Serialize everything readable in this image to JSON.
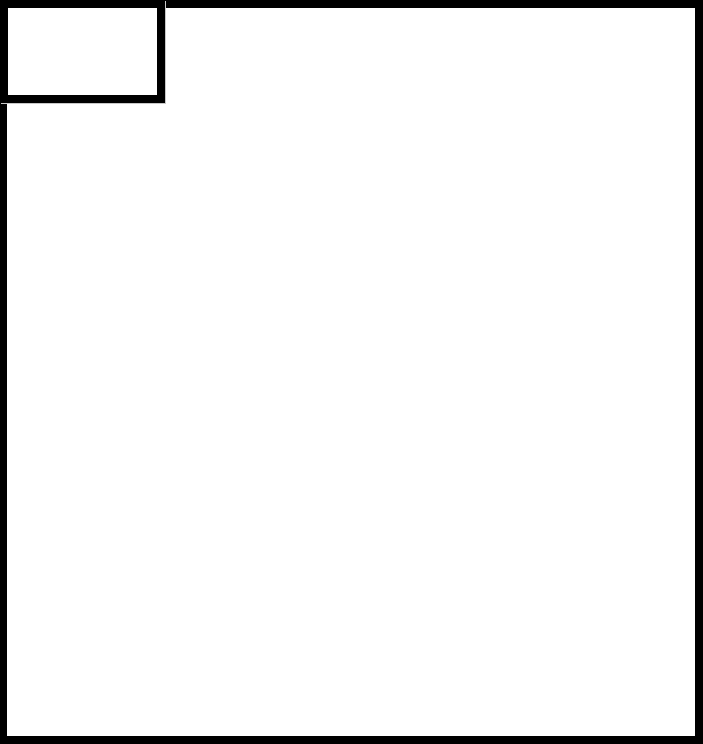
{
  "canvas": {
    "width_px": 703,
    "height_px": 744
  },
  "shapes": {
    "outer_frame": {
      "description": "large empty rectangle framing the whole canvas",
      "border_thickness_px": 8
    },
    "inset_box": {
      "description": "small empty rectangle attached to top-left corner",
      "width_px": 165,
      "height_px": 103,
      "border_thickness_px": 8
    }
  },
  "colors": {
    "frame": "#000000",
    "canvas_bg": "#ffffff",
    "shadow": "#c8c8c8"
  }
}
